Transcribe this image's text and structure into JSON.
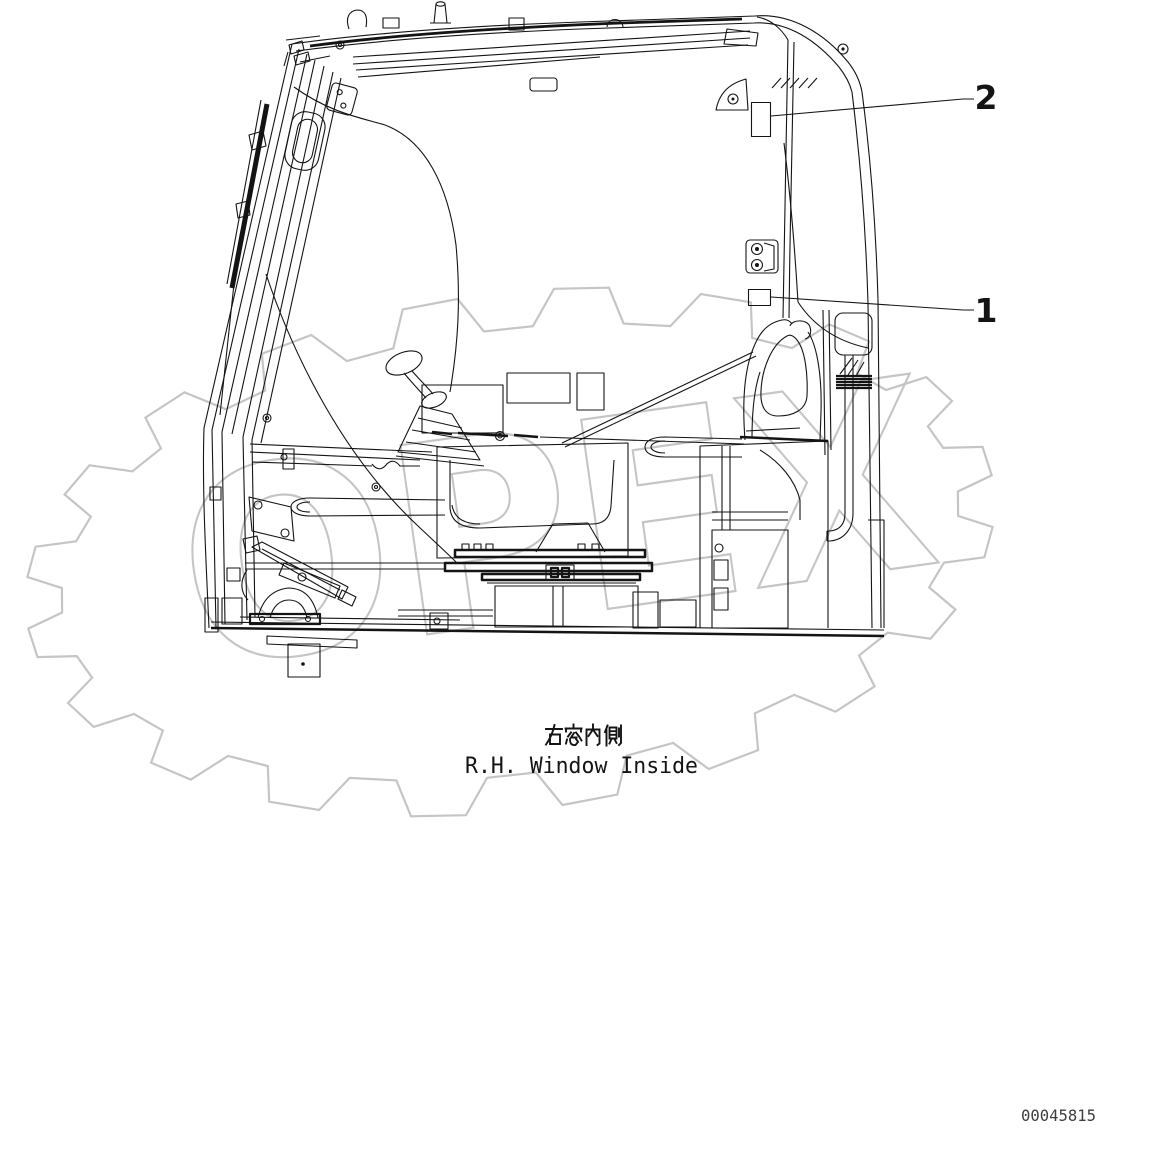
{
  "figure": {
    "title_view": "cab interior right-hand window side elevation",
    "caption_jp": "右窓内側",
    "caption_en": "R.H. Window Inside",
    "drawing_number": "00045815",
    "watermark": "OPEX",
    "callouts": [
      {
        "number": "1"
      },
      {
        "number": "2"
      }
    ]
  },
  "colors": {
    "line": "#141414",
    "watermark": "#c5c5c5",
    "background": "#ffffff"
  }
}
